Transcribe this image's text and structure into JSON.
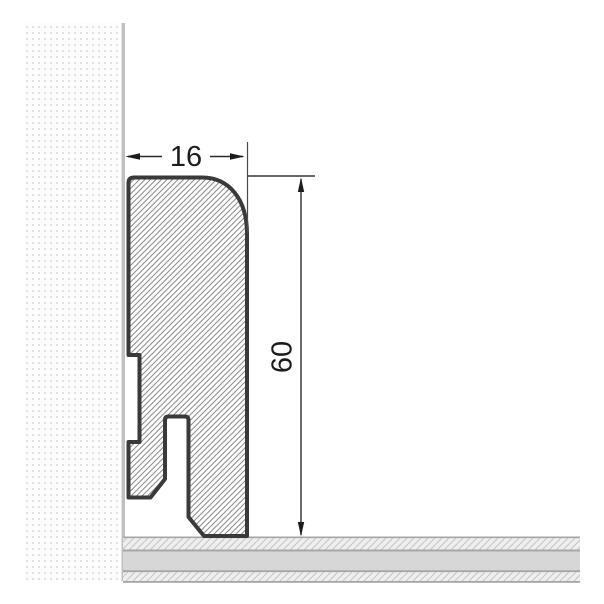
{
  "diagram": {
    "subject": "skirting-board-cross-section",
    "width_dimension_label": "16",
    "height_dimension_label": "60",
    "colors": {
      "background": "#ffffff",
      "profile_outline": "#3a3a3a",
      "profile_hatch_line": "#8c8c8c",
      "dimension_line": "#2a2a2a",
      "dimension_text": "#1c1c1c",
      "extension_line": "#4a4a4a",
      "wall_dot": "#d7d7d7",
      "wall_surface_line": "#c0c0c0",
      "floor_separator_line": "#a6a6a6",
      "floor_solid_fill": "#d7d7d7",
      "floor_hatch_fill": "#efefef",
      "floor_hatch_line": "#c6c6c6"
    }
  }
}
